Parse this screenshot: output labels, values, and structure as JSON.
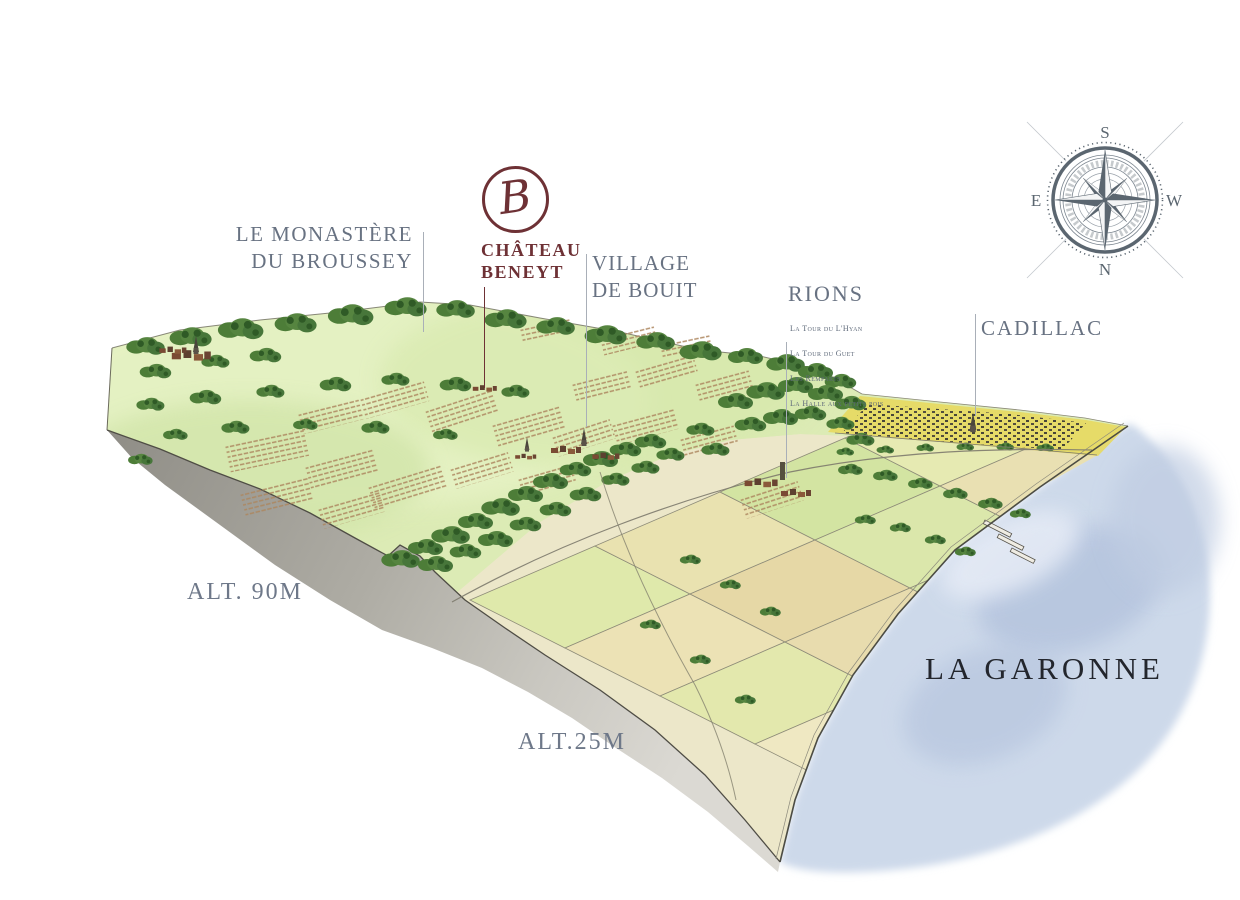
{
  "logo": {
    "initial": "B",
    "line1": "CHÂTEAU",
    "line2": "BENEYT"
  },
  "labels": {
    "monastere": {
      "line1": "LE MONASTÈRE",
      "line2": "DU BROUSSEY"
    },
    "village": {
      "line1": "VILLAGE",
      "line2": "DE BOUIT"
    },
    "rions": {
      "title": "RIONS",
      "items": [
        "La Tour du L'Hyan",
        "La Tour du Guet",
        "Les Remparts",
        "La Halle aux petits pois"
      ]
    },
    "cadillac": "CADILLAC",
    "alt_plateau": "ALT. 90M",
    "alt_plain": "ALT.25M",
    "river": "LA GARONNE"
  },
  "compass": {
    "top": "S",
    "bottom": "N",
    "left": "E",
    "right": "W"
  },
  "colors": {
    "brand_maroon": "#6e3135",
    "label_slate": "#687282",
    "river_text": "#23262d",
    "water": "#ccd8ea",
    "plateau_green": "#dcebb5",
    "compass": "#5b6670"
  }
}
